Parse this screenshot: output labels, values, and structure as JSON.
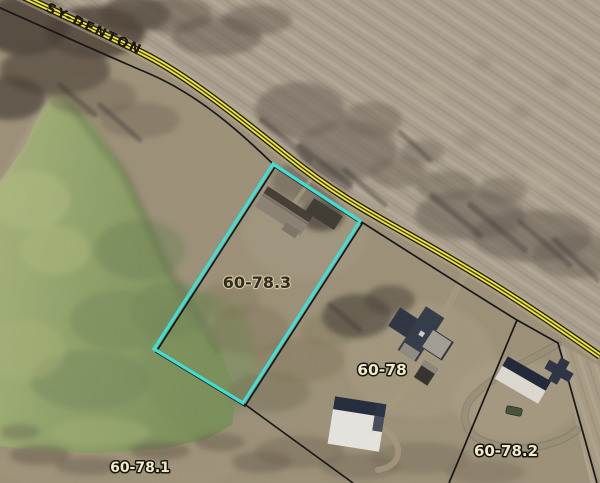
{
  "road": {
    "label": "SY-DENTON"
  },
  "parcels": [
    {
      "id": "60-78.3",
      "selected": true
    },
    {
      "id": "60-78",
      "selected": false
    },
    {
      "id": "60-78.1",
      "selected": false
    },
    {
      "id": "60-78.2",
      "selected": false
    }
  ],
  "colors": {
    "selection_outline": "#3EDFD6",
    "road_yellow": "#F2E42C",
    "road_casing": "#141414",
    "parcel_boundary": "#141414",
    "water": "#8FA06B",
    "farmland": "#A89D8B",
    "label_light": "#F3ECC9",
    "label_dark": "#2E2A21"
  }
}
